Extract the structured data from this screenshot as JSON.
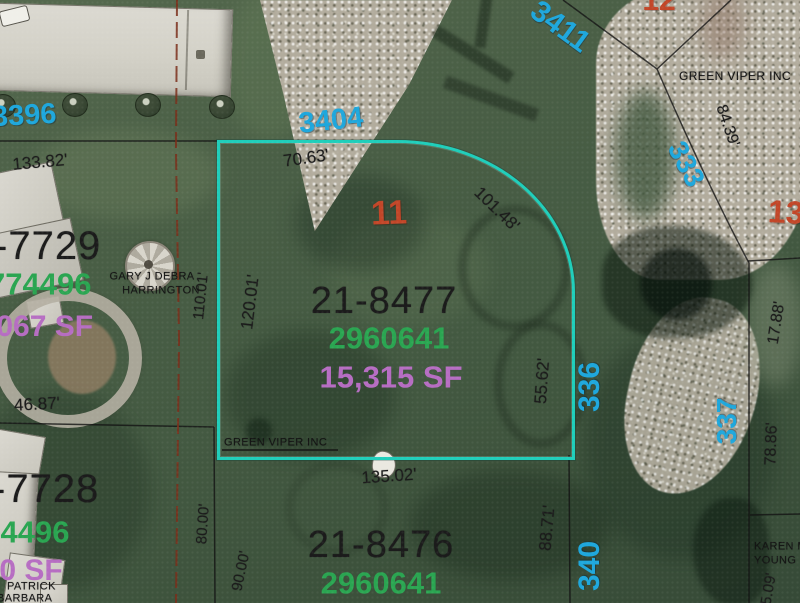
{
  "map": {
    "selected_parcel": {
      "lot_number": "11",
      "parcel_id": "21-8477",
      "alt_id": "2960641",
      "area": "15,315 SF",
      "owner": "GREEN VIPER INC",
      "dim_top": "70.63'",
      "dim_curve": "101.48'",
      "dim_left": "120.01'",
      "dim_right": "55.62'",
      "dim_bottom": "135.02'"
    },
    "parcel_south": {
      "parcel_id": "21-8476",
      "alt_id": "2960641",
      "dim_left": "90.00'",
      "dim_right": "88.71'"
    },
    "parcel_west_north": {
      "parcel_id": "-7729",
      "alt_id": "774496",
      "area": ",067 SF",
      "owner_line1": "GARY J DEBRA",
      "owner_line2": "HARRINGTON",
      "dim_top": "133.82'",
      "dim_right": "110.01'",
      "dim_bottom": "46.87'"
    },
    "parcel_west_south": {
      "parcel_id": "-7728",
      "alt_id": "774496",
      "area": "700 SF",
      "owner_line1": "PATRICK",
      "owner_line2": "BARBARA",
      "dim_right": "80.00'"
    },
    "parcel_ne": {
      "owner": "GREEN VIPER INC",
      "dim_curve": "84.39'"
    },
    "parcel_east": {
      "dim_top": "17.88'",
      "dim_right": "78.86'"
    },
    "parcel_se": {
      "owner_line1": "KAREN M",
      "owner_line2": "YOUNG",
      "dim_partial": "55.09'"
    },
    "street_numbers": {
      "n3396": "3396",
      "n3404": "3404",
      "n3411": "3411",
      "n333": "333",
      "n336": "336",
      "n337": "337",
      "n340": "340"
    },
    "lot_numbers": {
      "n11": "11",
      "n12": "12",
      "n13": "13"
    },
    "colors": {
      "parcel_highlight": "#1fceba",
      "street_number": "#1ea7dc",
      "lot_number": "#c24628",
      "alt_id_green": "#2aa551",
      "area_magenta": "#b66dc2",
      "survey_line_red": "#7a2e1a"
    }
  }
}
